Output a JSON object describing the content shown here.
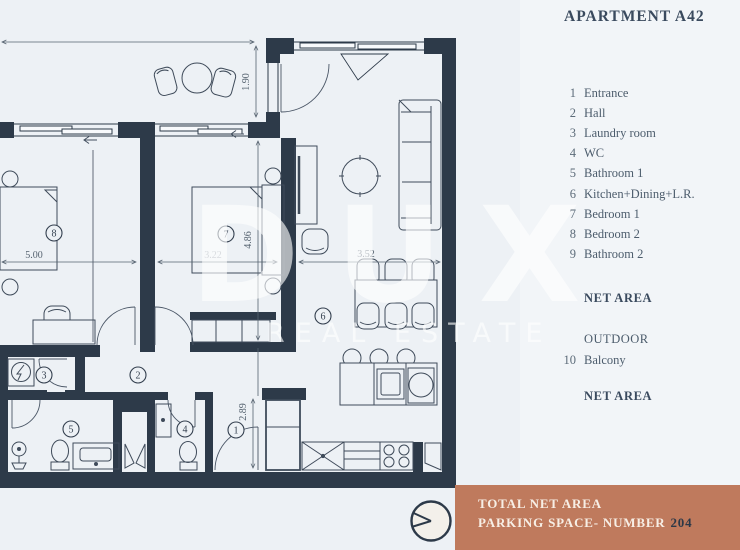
{
  "title": "APARTMENT A42",
  "legend": {
    "rooms": [
      {
        "num": "1",
        "label": "Entrance"
      },
      {
        "num": "2",
        "label": "Hall"
      },
      {
        "num": "3",
        "label": "Laundry room"
      },
      {
        "num": "4",
        "label": "WC"
      },
      {
        "num": "5",
        "label": "Bathroom 1"
      },
      {
        "num": "6",
        "label": "Kitchen+Dining+L.R."
      },
      {
        "num": "7",
        "label": "Bedroom 1"
      },
      {
        "num": "8",
        "label": "Bedroom 2"
      },
      {
        "num": "9",
        "label": "Bathroom 2"
      }
    ],
    "net_area_label": "NET AREA",
    "outdoor_label": "OUTDOOR",
    "outdoor_rooms": [
      {
        "num": "10",
        "label": "Balcony"
      }
    ],
    "net_area_label_2": "NET AREA"
  },
  "footer": {
    "total_net_area": "TOTAL NET AREA",
    "parking_label": "PARKING SPACE- NUMBER",
    "parking_number": "204"
  },
  "watermark": {
    "primary": "DUX",
    "secondary": "REAL ESTATE"
  },
  "plan": {
    "dims": {
      "balcony_depth": "1.90",
      "bedroom2_width": "5.00",
      "bedroom1_width": "3.22",
      "bedroom1_depth": "4.86",
      "living_width": "3.52",
      "entrance_depth": "2.89"
    },
    "room_numbers": {
      "entrance": "1",
      "hall": "2",
      "laundry": "3",
      "wc": "4",
      "bathroom1": "5",
      "kitchen": "6",
      "bedroom1": "7",
      "bedroom2": "8"
    }
  },
  "colors": {
    "wall": "#2d3a49",
    "accent": "#bf7a5d",
    "background": "#edf1f5"
  }
}
